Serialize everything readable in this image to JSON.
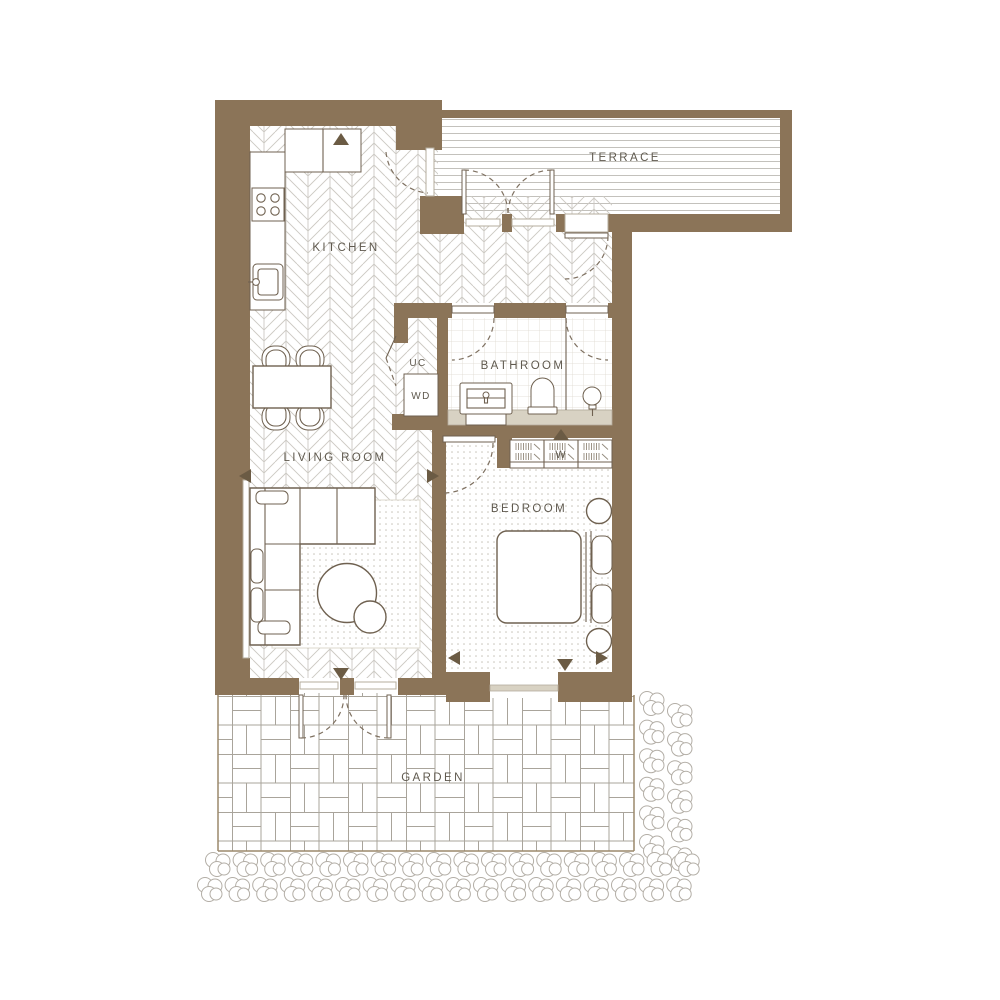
{
  "plan": {
    "rooms": {
      "kitchen": "KITCHEN",
      "terrace": "TERRACE",
      "bathroom": "BATHROOM",
      "living_room": "LIVING ROOM",
      "bedroom": "BEDROOM",
      "garden": "GARDEN"
    },
    "closets": {
      "utility_cupboard": "UC",
      "washer_dryer": "WD",
      "wardrobe": "W"
    },
    "colors": {
      "wall": "#8b7458",
      "line": "#6f6150",
      "label": "#5f594e",
      "glazing": "#d8d2c3",
      "floor_pattern": "#cbc8c2"
    }
  }
}
